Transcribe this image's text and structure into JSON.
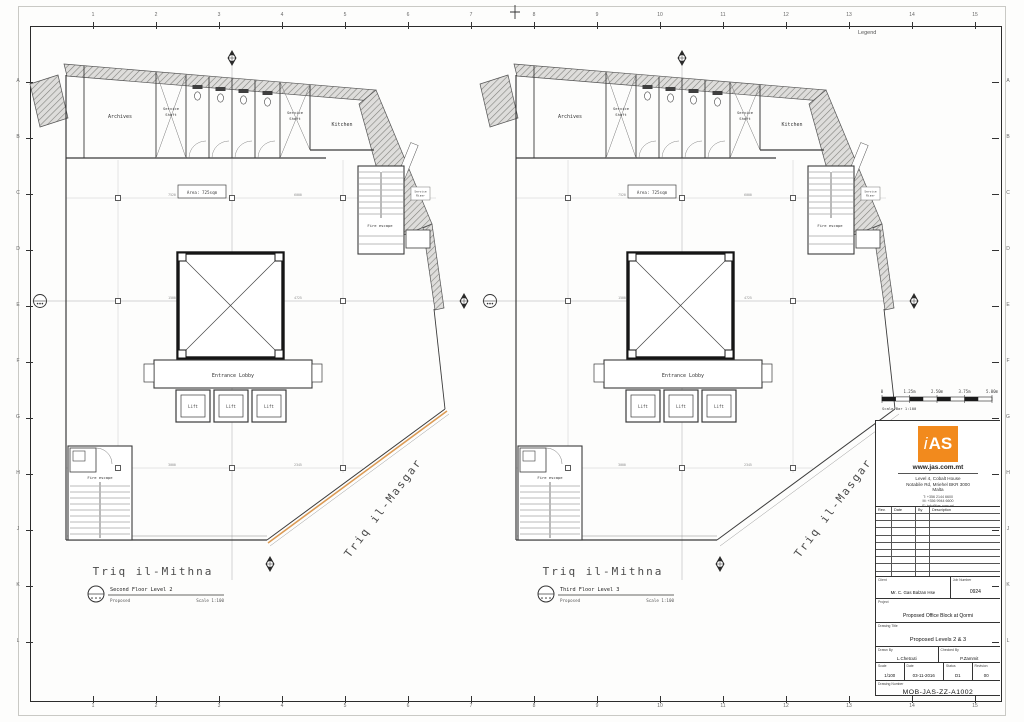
{
  "sheet": {
    "legend_label": "Legend",
    "border_numbers": [
      "1",
      "2",
      "3",
      "4",
      "5",
      "6",
      "7",
      "8",
      "9",
      "10",
      "11",
      "12",
      "13",
      "14",
      "15"
    ],
    "border_letters": [
      "A",
      "B",
      "C",
      "D",
      "E",
      "F",
      "G",
      "H",
      "J",
      "K",
      "L"
    ]
  },
  "plan_common": {
    "rooms": {
      "archives": "Archives",
      "service_shaft_line1": "Service",
      "service_shaft_line2": "Shaft",
      "kitchen": "Kitchen",
      "fire_escape": "Fire escape",
      "entrance_lobby": "Entrance Lobby",
      "lift": "Lift",
      "riser_line1": "Service",
      "riser_line2": "Riser",
      "area_label": "Area: 725sqm"
    },
    "streets": {
      "bottom": "Triq il-Mithna",
      "side": "Triq il-Masgar"
    },
    "dims": [
      "7520",
      "6000",
      "1500",
      "4725",
      "3000",
      "2345"
    ]
  },
  "plans": [
    {
      "bubble": {
        "title": "Second Floor Level 2",
        "status": "Proposed",
        "scale": "Scale 1:100"
      },
      "boundary_highlight": true
    },
    {
      "bubble": {
        "title": "Third Floor Level 3",
        "status": "Proposed",
        "scale": "Scale 1:100"
      },
      "boundary_highlight": false
    }
  ],
  "scalebar": {
    "labels": [
      "0",
      "1.25m",
      "2.50m",
      "3.75m",
      "5.00m"
    ],
    "caption": "Scale Bar 1:100"
  },
  "titleblock": {
    "logo_text": "AS",
    "logo_prefix": "i",
    "website": "www.jas.com.mt",
    "address_lines": [
      "Level 4, Cobalt House",
      "Notabile Rd, Mriehel BKR 3000",
      "Malta"
    ],
    "contact_lines": [
      "T: +356 2144 6600",
      "M: +356 9944 6600",
      "E: info@jas.com.mt"
    ],
    "revisions": {
      "rev": "Rev.",
      "date": "Date",
      "by": "By",
      "description": "Description"
    },
    "client_label": "Client",
    "client_value": "Mr. C. Gas Balzan Hse",
    "job_label": "Job Number",
    "job_value": "0924",
    "project_label": "Project",
    "project_value": "Proposed Office Block at Qormi",
    "drawing_title_label": "Drawing Title",
    "drawing_title_value": "Proposed Levels 2 & 3",
    "drawn_label": "Drawn By",
    "drawn_value": "L.Chetcuti",
    "checked_label": "Checked By",
    "checked_value": "P.Zammit",
    "scale_label": "Scale",
    "scale_value": "1/100",
    "date_label": "Date",
    "date_value": "03-11-2016",
    "status_label": "Status",
    "status_value": "D1",
    "revision_label": "Revision",
    "revision_value": "00",
    "number_label": "Drawing Number",
    "number_value": "MOB-JAS-ZZ-A1002"
  },
  "colors": {
    "logo_orange": "#F28A1D",
    "boundary_orange": "#DC9B55"
  }
}
